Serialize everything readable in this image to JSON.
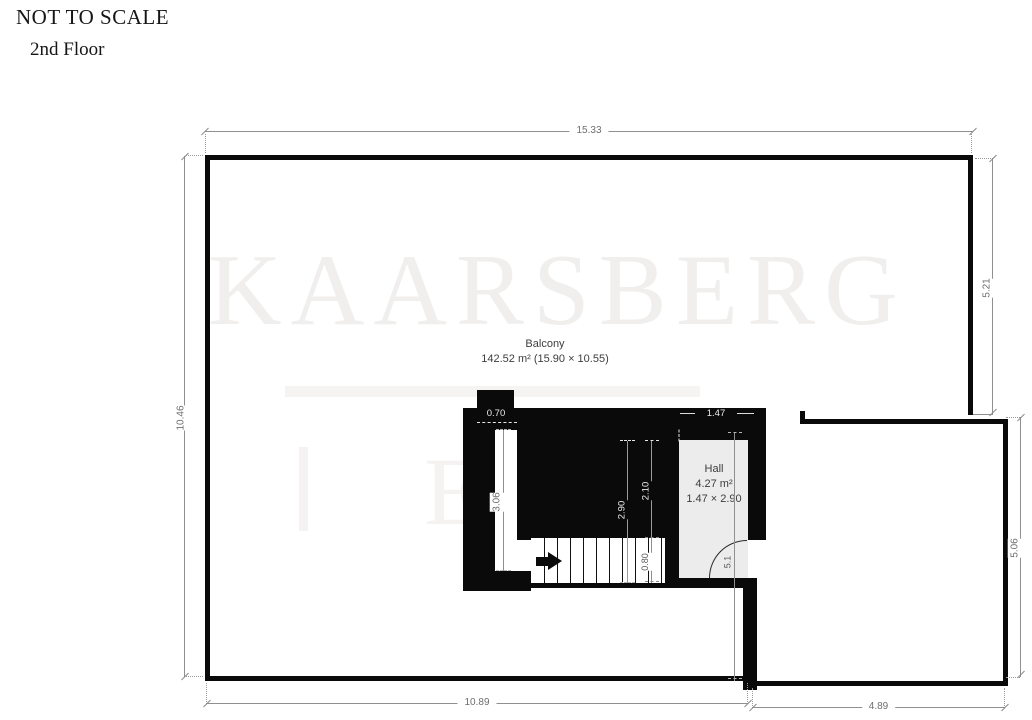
{
  "header": {
    "not_to_scale": "NOT TO SCALE",
    "floor": "2nd Floor"
  },
  "watermark": {
    "text": "KAARSBERG",
    "fragment": "E"
  },
  "rooms": {
    "balcony": {
      "name": "Balcony",
      "area": "142.52 m² (15.90 × 10.55)"
    },
    "hall": {
      "name": "Hall",
      "area": "4.27 m²",
      "size": "1.47 × 2.90"
    }
  },
  "dims": {
    "top": "15.33",
    "left": "10.46",
    "right_upper": "5.21",
    "right_lower": "5.06",
    "bottom_left": "10.89",
    "bottom_right": "4.89",
    "notch_width": "0.70",
    "hall_width": "1.47",
    "stair_left": "3.06",
    "stair_run": "2.90",
    "stair_upper": "2.10",
    "stair_width": "0.80",
    "hall_depth": "5.1"
  },
  "icons": {
    "stairs_direction": "right-arrow"
  },
  "colors": {
    "wall": "#0a0a0a",
    "hall_fill": "#ececec",
    "dim_line": "#8f8f8f",
    "dim_text": "#6e6e6e",
    "room_text": "#3d3d3d",
    "watermark": "#efedea"
  }
}
